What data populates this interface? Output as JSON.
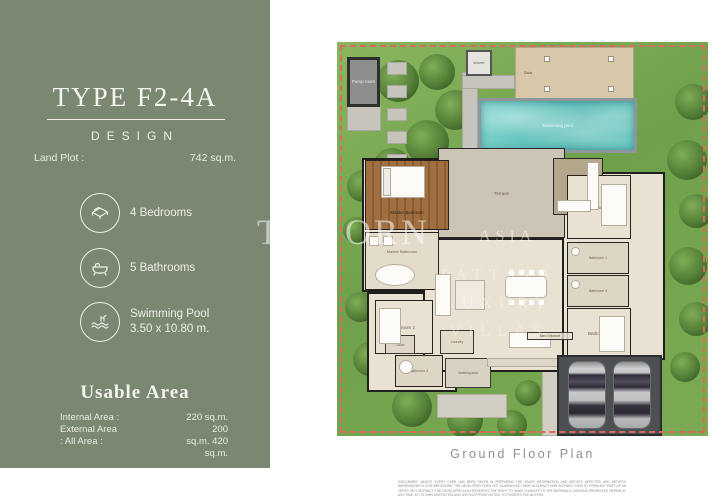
{
  "brochure": {
    "title": "TYPE F2-4A",
    "subtitle": "DESIGN",
    "land_plot": {
      "label": "Land Plot :",
      "value": "742 sq.m."
    },
    "features": [
      {
        "icon": "bed-icon",
        "label": "4 Bedrooms"
      },
      {
        "icon": "bathtub-icon",
        "label": "5 Bathrooms"
      },
      {
        "icon": "pool-icon",
        "label": "Swimming Pool",
        "detail": "3.50 x 10.80 m."
      }
    ],
    "usable_area": {
      "title": "Usable Area",
      "rows": [
        {
          "label": "Internal Area :",
          "value": "220 sq.m."
        },
        {
          "label": "External Area",
          "value": "200"
        },
        {
          "label": ": All Area :",
          "value": "sq.m. 420"
        },
        {
          "label": "",
          "value": "sq.m."
        }
      ]
    }
  },
  "floor_plan": {
    "caption": "Ground Floor Plan",
    "labels": {
      "pump_room": "Pump room",
      "shower": "shower",
      "sala": "Sala",
      "pool": "Swimming pool",
      "master_bedroom": "Master Bedroom",
      "master_bathroom": "Master Bathroom",
      "terrace": "Terrace",
      "sunken": "Sunken",
      "bedroom1": "Bedroom 1",
      "bedroom2": "Bedroom 2",
      "bedroom3": "Bedroom 3",
      "bathroom1": "Bathroom 1",
      "bathroom2": "Bathroom 2",
      "bathroom3": "Bathroom 3",
      "living": "Living",
      "dining": "Dining",
      "kitchen": "Kitchen",
      "laundry": "Laundry",
      "closet": "Closet",
      "washing_area": "Washing area",
      "main_entrance": "Main Entrance"
    },
    "disclaimer": "DISCLAIMER: WHILST EVERY CARE HAS BEEN TAKEN IN PREPARING THE SALES INFORMATION AND ARTISTS DEPICTED AND ARTISTIC IMPRESSIONS IN THIS BROCHURE, THE DEVELOPER DOES NOT GUARANTEE THEIR ACCURACY NOR INTENDS THEM TO FORM ANY PART OF AN OFFER OR CONTRACT. THE DEVELOPER ALSO RESERVES THE RIGHT TO MAKE CHANGES TO THE MATERIALS, DESIGNS PRESENTED HEREIN AT ANY TIME, AT ITS OWN DISCRETION AND WITHOUT PRIOR NOTICE TO PROSPECTIVE BUYERS."
  },
  "watermarks": {
    "brand_part1": "TH",
    "brand_part2": "ORN",
    "brand_part3": "ASIA",
    "overlay_lines": [
      "PATTAYA",
      "LUXURY",
      "VILLAS"
    ]
  },
  "colors": {
    "panel_green": "#7b8871",
    "garden_green": "#6fa04b",
    "pool_teal": "#6ec9c3",
    "deck_tan": "#d8c7a8",
    "floor_cream": "#e9e1d1",
    "terrace_gray": "#ccc4b4",
    "boundary_red": "#dd695e",
    "carport_gray": "#4d5052"
  }
}
